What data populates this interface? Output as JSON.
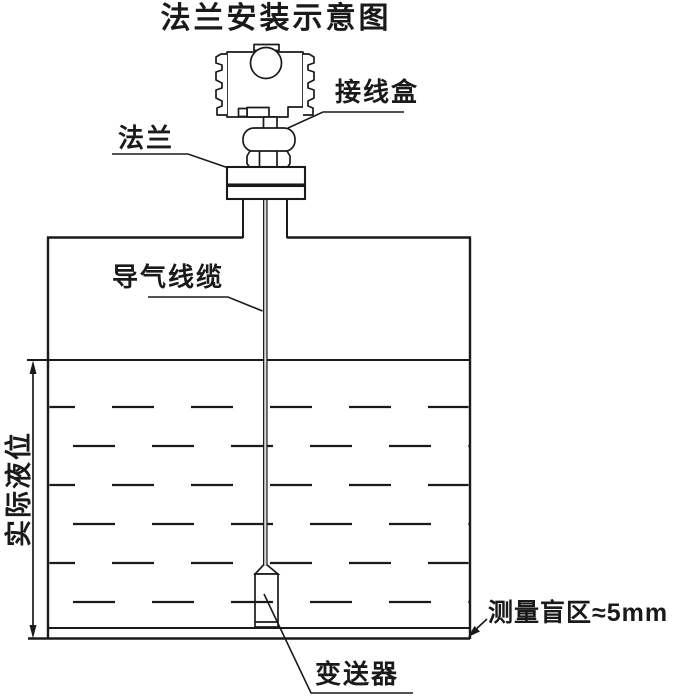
{
  "title": "法兰安装示意图",
  "labels": {
    "junction_box": "接线盒",
    "flange": "法兰",
    "air_guide_cable": "导气线缆",
    "actual_level": "实际液位",
    "blind_zone": "测量盲区≈5mm",
    "transmitter": "变送器"
  },
  "colors": {
    "line": "#1a1a1a",
    "background": "#ffffff"
  }
}
